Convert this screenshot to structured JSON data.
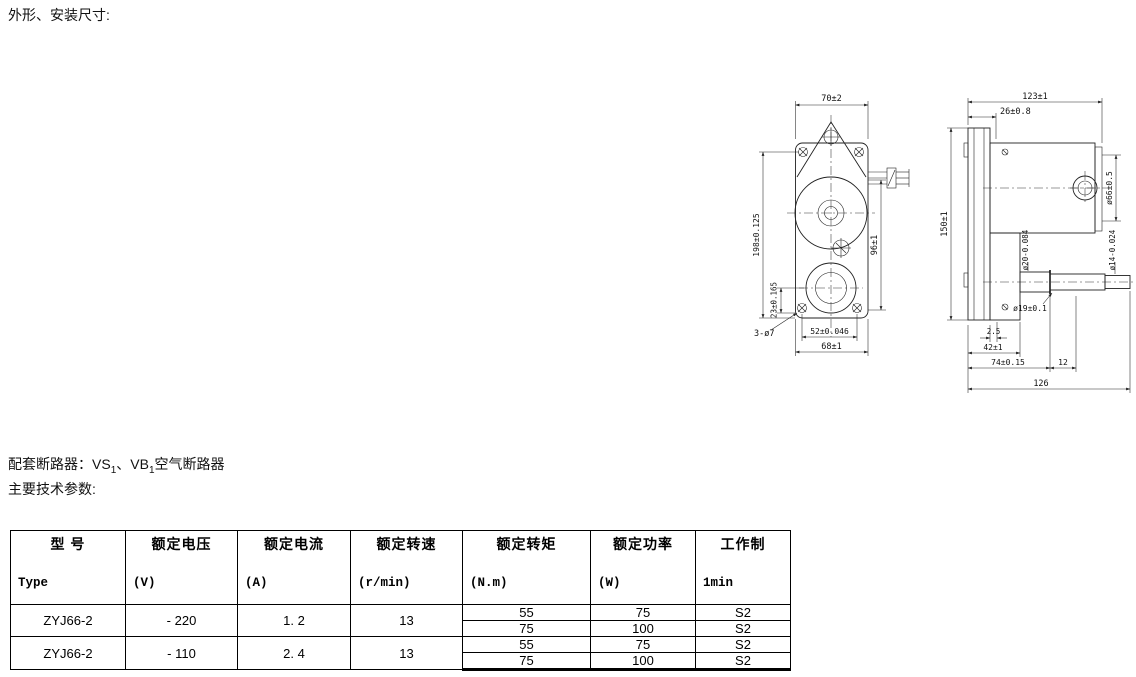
{
  "page": {
    "title_dimensions": "外形、安装尺寸:",
    "breaker_parts": [
      "配套断路器：VS",
      "1",
      "、VB",
      "1",
      "空气断路器"
    ],
    "title_params": "主要技术参数:"
  },
  "drawings": {
    "front": {
      "width_top": "70±2",
      "height_overall": "198±0.125",
      "height_body": "96±1",
      "offset_bottom": "23±0.165",
      "holes_note": "3-ø7",
      "hole_span": "52±0.046",
      "width_bottom": "68±1"
    },
    "side": {
      "length_overall_top": "123±1",
      "plate_to_body": "26±0.8",
      "height_overall": "150±1",
      "body_dia": "ø66±0.5",
      "shaft_step_dia": "ø20-0.084",
      "shaft_end_dia": "ø14-0.024",
      "hub_dia": "ø19±0.1",
      "plate_thickness": "2.5",
      "case_length": "42±1",
      "shoulder_length": "74±0.15",
      "step_length": "12",
      "length_overall_bottom": "126"
    }
  },
  "table": {
    "headers": [
      {
        "cn": "型 号",
        "en": "Type"
      },
      {
        "cn": "额定电压",
        "en": "(V)"
      },
      {
        "cn": "额定电流",
        "en": "(A)"
      },
      {
        "cn": "额定转速",
        "en": "(r/min)"
      },
      {
        "cn": "额定转矩",
        "en": "(N.m)"
      },
      {
        "cn": "额定功率",
        "en": "(W)"
      },
      {
        "cn": "工作制",
        "en": "1min"
      }
    ],
    "rows": [
      {
        "type": "ZYJ66-2",
        "voltage": "- 220",
        "current": "1. 2",
        "speed": "13",
        "sub": [
          {
            "torque": "55",
            "power": "75",
            "duty": "S2"
          },
          {
            "torque": "75",
            "power": "100",
            "duty": "S2"
          }
        ]
      },
      {
        "type": "ZYJ66-2",
        "voltage": "- 110",
        "current": "2. 4",
        "speed": "13",
        "sub": [
          {
            "torque": "55",
            "power": "75",
            "duty": "S2"
          },
          {
            "torque": "75",
            "power": "100",
            "duty": "S2"
          }
        ]
      }
    ]
  }
}
